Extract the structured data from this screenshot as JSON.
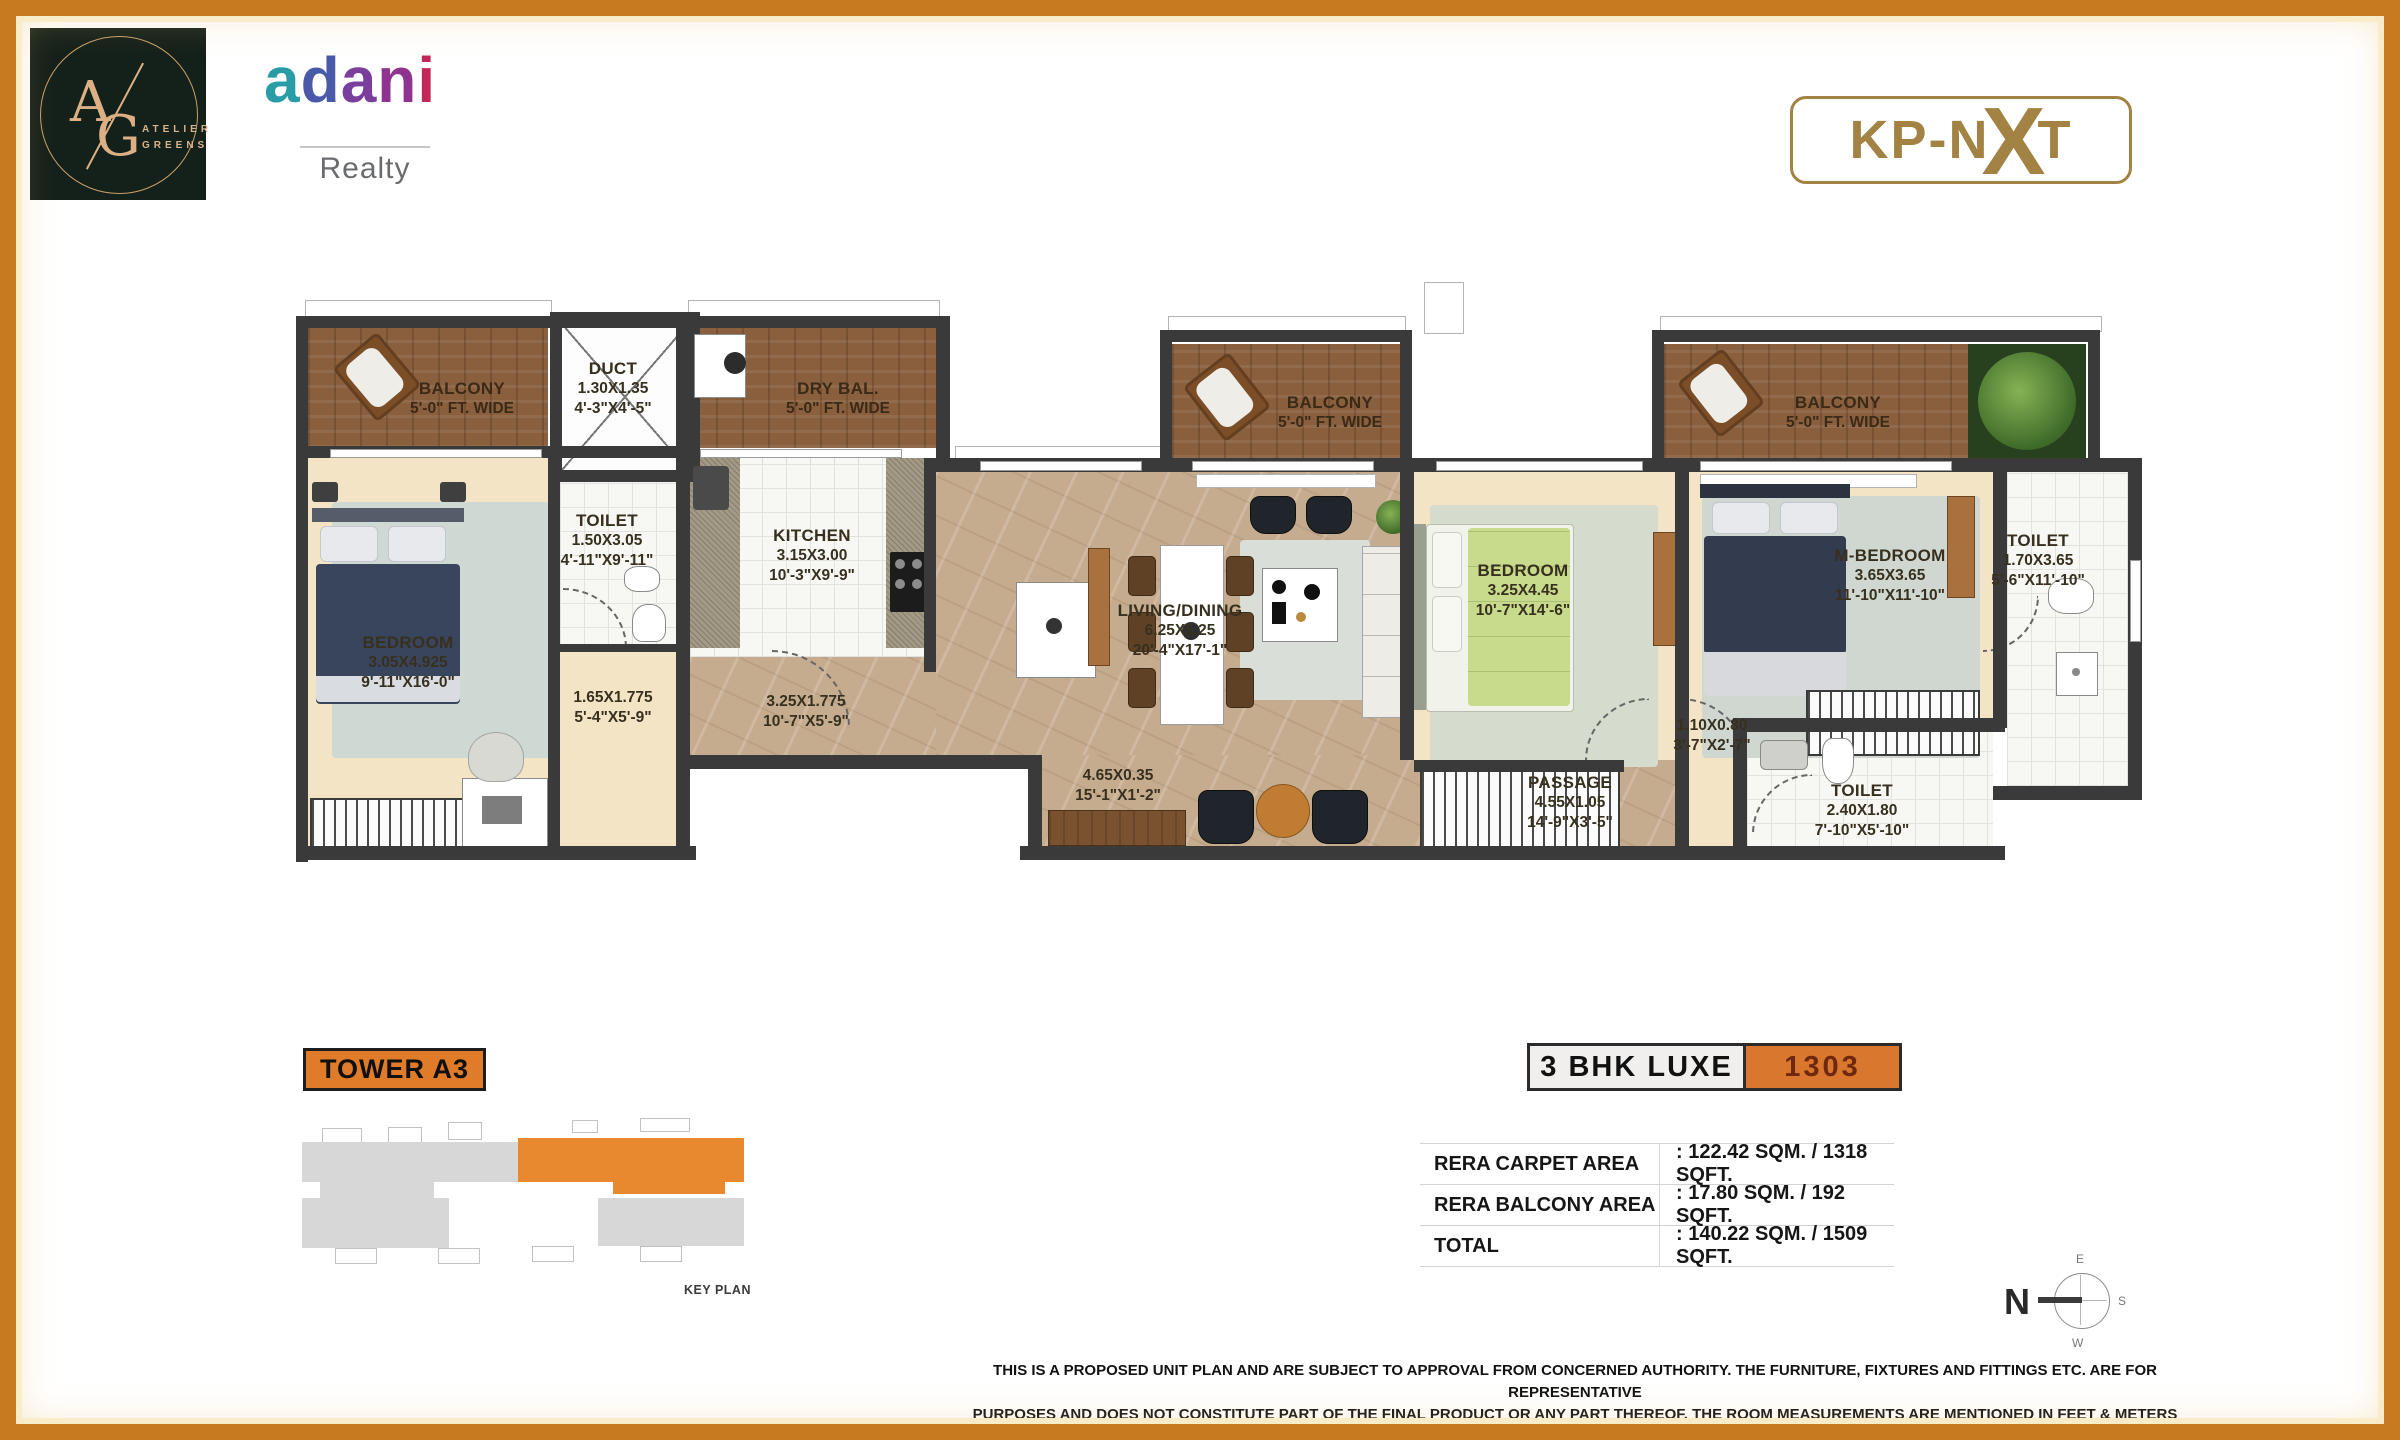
{
  "colors": {
    "frame_orange": "#c87a1e",
    "accent_orange": "#d9772e",
    "wall": "#3a3a3a",
    "brand_gold": "#a28343",
    "wood": "#8a5f3e"
  },
  "header": {
    "logo_a": "A",
    "logo_g": "G",
    "logo_line1": "ATELIER",
    "logo_line2": "GREENS",
    "brand_letters": [
      "a",
      "d",
      "a",
      "n",
      "i"
    ],
    "brand_sub": "Realty",
    "kp_left": "KP-N",
    "kp_x": "X",
    "kp_right": "T"
  },
  "rooms": [
    {
      "name": "BALCONY",
      "l1": "5'-0\" FT. WIDE",
      "l2": ""
    },
    {
      "name": "DUCT",
      "l1": "1.30X1.35",
      "l2": "4'-3\"X4'-5\""
    },
    {
      "name": "DRY BAL.",
      "l1": "5'-0\" FT. WIDE",
      "l2": ""
    },
    {
      "name": "TOILET",
      "l1": "1.50X3.05",
      "l2": "4'-11\"X9'-11\""
    },
    {
      "name": "KITCHEN",
      "l1": "3.15X3.00",
      "l2": "10'-3\"X9'-9\""
    },
    {
      "name": "BEDROOM",
      "l1": "3.05X4.925",
      "l2": "9'-11\"X16'-0\""
    },
    {
      "name": "",
      "l1": "1.65X1.775",
      "l2": "5'-4\"X5'-9\""
    },
    {
      "name": "",
      "l1": "3.25X1.775",
      "l2": "10'-7\"X5'-9\""
    },
    {
      "name": "LIVING/DINING",
      "l1": "6.25X5.25",
      "l2": "20'-4\"X17'-1\""
    },
    {
      "name": "BALCONY",
      "l1": "5'-0\" FT. WIDE",
      "l2": ""
    },
    {
      "name": "BEDROOM",
      "l1": "3.25X4.45",
      "l2": "10'-7\"X14'-6\""
    },
    {
      "name": "M-BEDROOM",
      "l1": "3.65X3.65",
      "l2": "11'-10\"X11'-10\""
    },
    {
      "name": "BALCONY",
      "l1": "5'-0\" FT. WIDE",
      "l2": ""
    },
    {
      "name": "TOILET",
      "l1": "1.70X3.65",
      "l2": "5'-6\"X11'-10\""
    },
    {
      "name": "",
      "l1": "4.65X0.35",
      "l2": "15'-1\"X1'-2\""
    },
    {
      "name": "PASSAGE",
      "l1": "4.55X1.05",
      "l2": "14'-9\"X3'-5\""
    },
    {
      "name": "",
      "l1": "1.10X0.80",
      "l2": "3'-7\"X2'-7\""
    },
    {
      "name": "TOILET",
      "l1": "2.40X1.80",
      "l2": "7'-10\"X5'-10\""
    }
  ],
  "footer": {
    "tower_label": "TOWER A3",
    "key_plan_caption": "KEY PLAN",
    "unit_type": "3 BHK LUXE",
    "unit_number": "1303",
    "areas": [
      {
        "label": "RERA CARPET AREA",
        "value": ": 122.42 SQM. / 1318 SQFT."
      },
      {
        "label": "RERA BALCONY AREA",
        "value": ":  17.80 SQM. /  192 SQFT."
      },
      {
        "label": "TOTAL",
        "value": ": 140.22 SQM. / 1509 SQFT."
      }
    ],
    "compass": {
      "n": "N",
      "e": "E",
      "s": "S",
      "w": "W"
    },
    "disclaimer1": "THIS IS A PROPOSED UNIT PLAN AND ARE SUBJECT TO APPROVAL FROM CONCERNED AUTHORITY. THE FURNITURE, FIXTURES AND FITTINGS ETC. ARE FOR REPRESENTATIVE",
    "disclaimer2": "PURPOSES AND DOES NOT CONSTITUTE PART OF THE FINAL PRODUCT OR ANY PART THEREOF. THE ROOM MEASUREMENTS ARE MENTIONED IN FEET & METERS"
  }
}
